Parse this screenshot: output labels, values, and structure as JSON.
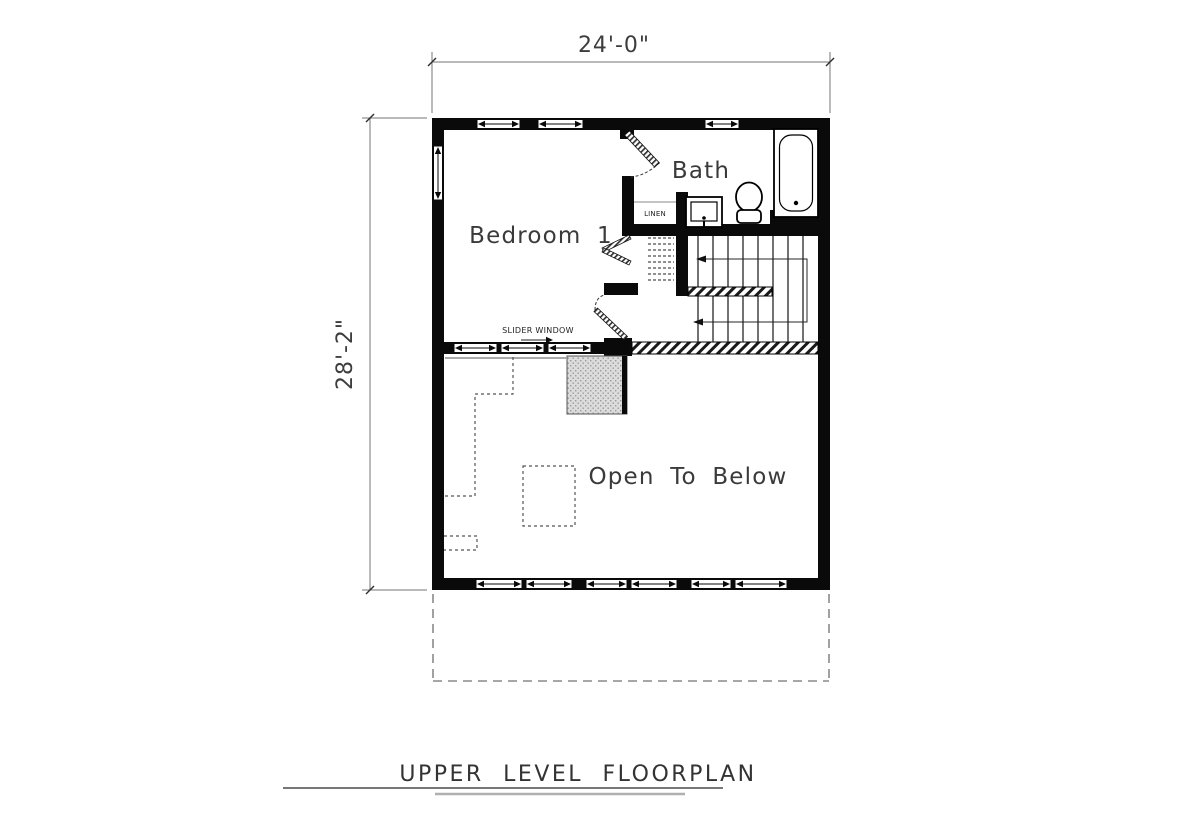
{
  "title": {
    "text": "UPPER LEVEL FLOORPLAN"
  },
  "dimensions": {
    "top": "24'-0\"",
    "left": "28'-2\""
  },
  "rooms": {
    "bedroom1": "Bedroom 1",
    "bath": "Bath",
    "open_to_below": "Open To Below"
  },
  "annotations": {
    "slider_window": "SLIDER WINDOW",
    "linen": "LINEN"
  },
  "colors": {
    "wall": "#0a0a0a",
    "dimension_line": "#767676",
    "label_text": "#3a3a3a",
    "background": "#ffffff"
  }
}
